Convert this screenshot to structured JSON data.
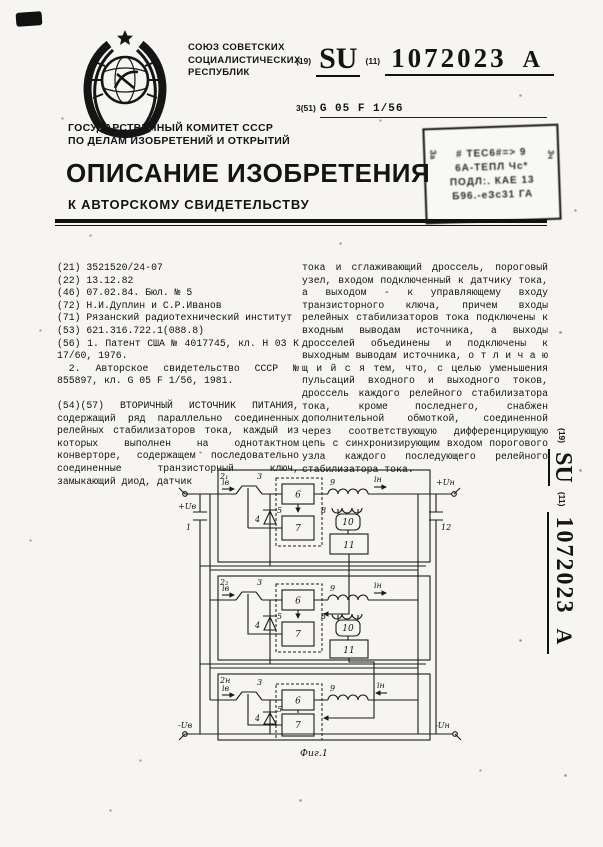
{
  "header": {
    "union_lines": [
      "СОЮЗ СОВЕТСКИХ",
      "СОЦИАЛИСТИЧЕСКИХ",
      "РЕСПУБЛИК"
    ],
    "code19": "(19)",
    "country": "SU",
    "code11": "(11)",
    "doc_number": "1072023",
    "kind_code": "A",
    "class_prefix": "3(51)",
    "ipc_class": "G 05 F 1/56",
    "committee_lines": [
      "ГОСУДАРСТВЕННЫЙ КОМИТЕТ СССР",
      "ПО ДЕЛАМ ИЗОБРЕТЕНИЙ И ОТКРЫТИЙ"
    ],
    "doc_type_title": "ОПИСАНИЕ ИЗОБРЕТЕНИЯ",
    "doc_type_subtitle": "К АВТОРСКОМУ СВИДЕТЕЛЬСТВУ"
  },
  "stamp": {
    "lines": [
      "# ТЕС6#=> 9",
      "6А-ТЕПЛ Чс*",
      "ПОДЛ:. КАЕ 13",
      "Б96.-еЗс31 ГА"
    ],
    "side_left": "За",
    "side_right": "3ч"
  },
  "biblio": {
    "lines": [
      "(21) 3521520/24-07",
      "(22) 13.12.82",
      "(46) 07.02.84. Бюл. № 5",
      "(72) Н.И.Дуплин и С.Р.Иванов",
      "(71) Рязанский радиотехнический институт",
      "(53) 621.316.722.1(088.8)",
      "(56) 1. Патент США № 4017745, кл. Н 03 К 17/60, 1976.",
      "2. Авторское свидетельство СССР № 855897, кл. G 05 F 1/56, 1981."
    ]
  },
  "abstract": {
    "left": "(54)(57) ВТОРИЧНЫЙ ИСТОЧНИК ПИТАНИЯ, содержащий ряд параллельно соединенных релейных стабилизаторов тока, каждый из которых выполнен на однотактном конверторе, содержащем последовательно соединенные транзисторный ключ, замыкающий диод, датчик",
    "right": "тока и сглаживающий дроссель, пороговый узел, входом подключенный к датчику тока, а выходом - к управляющему входу транзисторного ключа, причем входы релейных стабилизаторов тока подключены к входным выводам источника, а выходы дросселей объединены и подключены к выходным выводам источника, о т л и ч а ю щ и й с я  тем, что, с целью уменьшения пульсаций входного и выходного токов, дроссель каждого релейного стабилизатора тока, кроме последнего, снабжен дополнительной обмоткой, соединенной через соответствующую дифференцирующую цепь с синхронизирующим входом порогового узла каждого последующего релейного стабилизатора тока."
  },
  "diagram": {
    "caption": "Фиг.1",
    "labels": {
      "cap_in": "1",
      "cap_out": "12",
      "stage1": "2₁",
      "stage2": "2₂",
      "stage_n": "2н",
      "transistor": "3",
      "diode": "4",
      "control_box": "5",
      "block6": "6",
      "block7": "7",
      "winding": "8",
      "choke": "9",
      "diff": "10",
      "block11": "11",
      "i_in": "iв",
      "i_out": "iн",
      "u_in_plus": "+Uв",
      "u_in_minus": "-Uв",
      "u_out_plus": "+Uн",
      "u_out_minus": "-Uн"
    }
  },
  "sidebar": {
    "code19": "(19)",
    "country": "SU",
    "code11": "(11)",
    "doc_number": "1072023",
    "kind_code": "A"
  }
}
